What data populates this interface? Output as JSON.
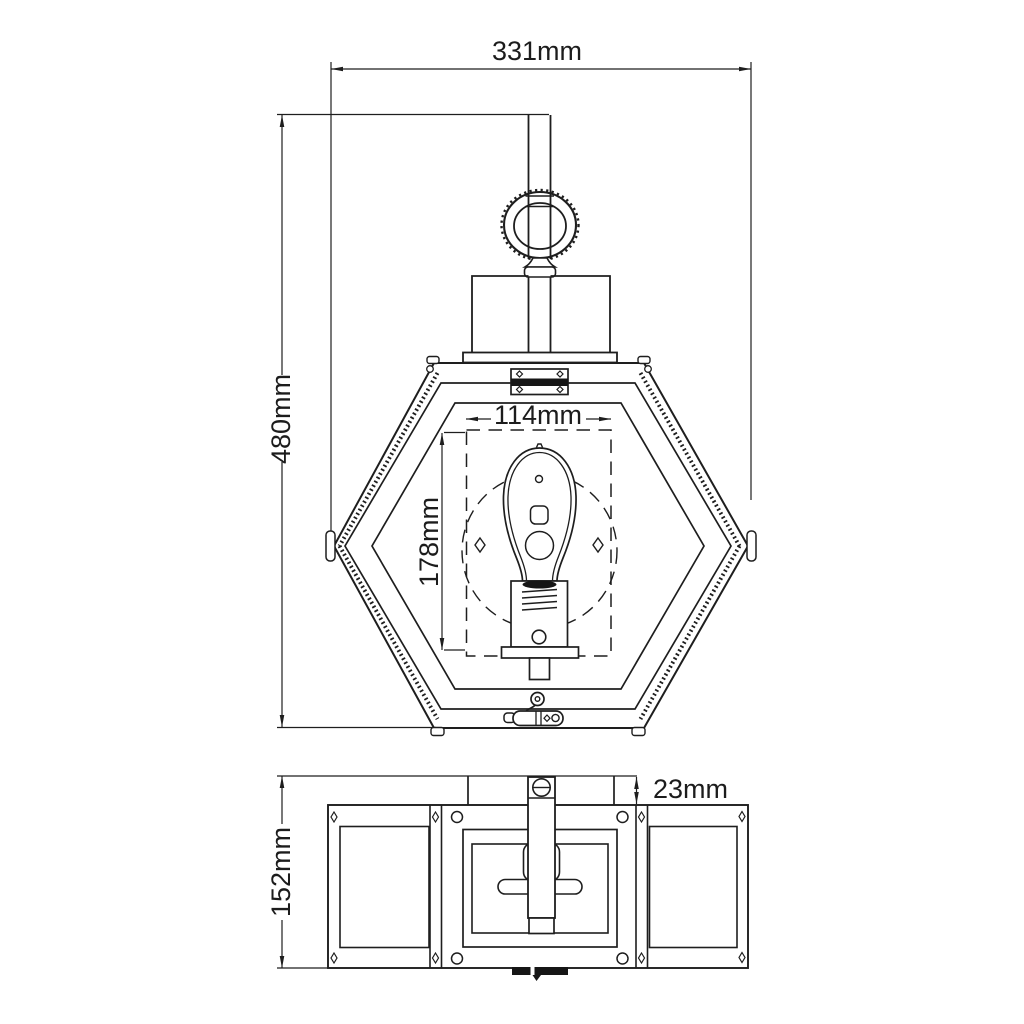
{
  "page": {
    "background": "#ffffff",
    "line_color": "#1e1e1e",
    "text_color": "#1c1c1c"
  },
  "drawing": {
    "type": "technical-dimension-drawing",
    "subject": "hexagonal wall lantern with Edison bulb, front elevation and bottom view",
    "views": {
      "front": {
        "name": "front elevation",
        "dims": {
          "overall_width": "331mm",
          "overall_height": "480mm",
          "cage_width": "114mm",
          "cage_height": "178mm"
        }
      },
      "bottom": {
        "name": "bottom view",
        "dims": {
          "body_depth": "152mm",
          "backplate_depth": "23mm"
        }
      }
    }
  }
}
